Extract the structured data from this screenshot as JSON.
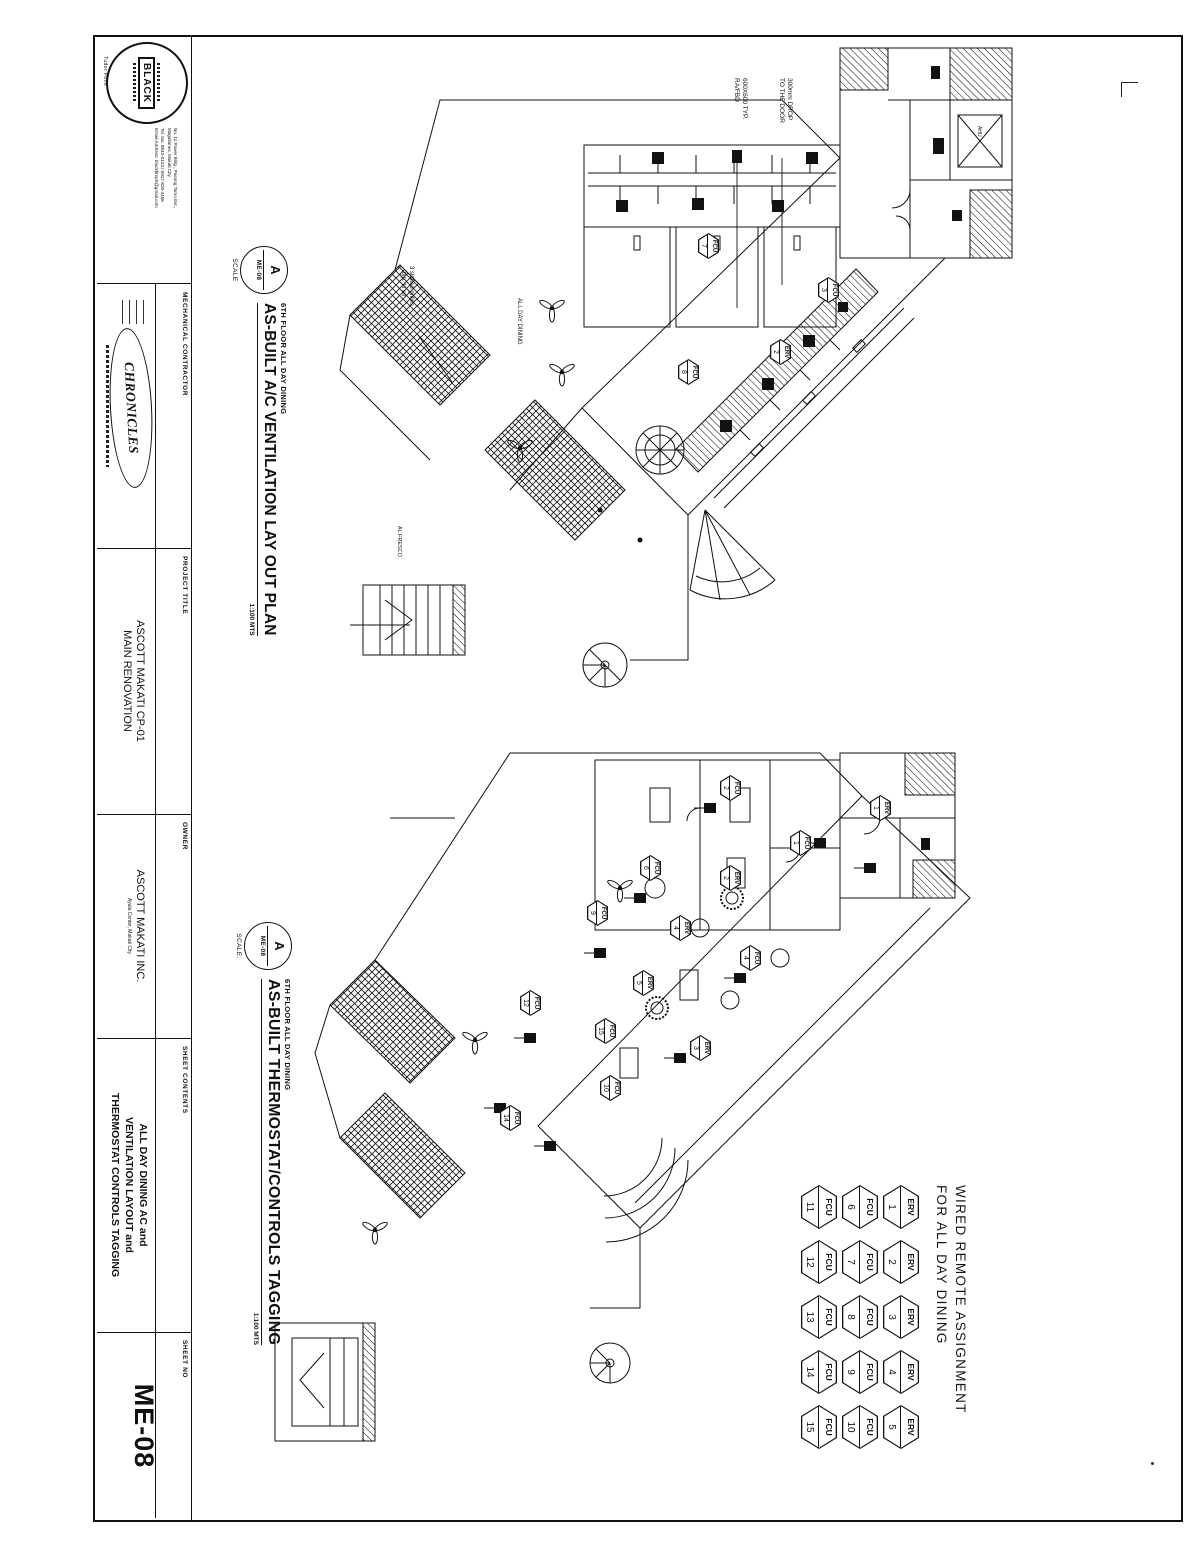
{
  "page": {
    "bg": "#ffffff",
    "ink": "#111111"
  },
  "titleblock": {
    "logo": {
      "text": "BLACK",
      "tagline": "Tudor Point",
      "address_lines": [
        "No. 11 Power Bldg., Pasong Tamo Ext.,",
        "Magallanes, Makati City",
        "Tel. No. 8844-0123 / 0917-820-4455",
        "Email Address: blackfireph@gmail.com"
      ]
    },
    "contractor": {
      "label": "MECHANICAL CONTRACTOR",
      "stamp": "CHRONICLES"
    },
    "project": {
      "label": "PROJECT TITLE",
      "line1": "ASCOTT MAKATI CP-01",
      "line2": "MAIN RENOVATION"
    },
    "owner": {
      "label": "OWNER",
      "name": "ASCOTT MAKATI INC.",
      "address": "Ayala Center, Makati City"
    },
    "contents": {
      "label": "SHEET CONTENTS",
      "line1": "ALL DAY DINING AC and",
      "line2": "VENTILATION LAYOUT and",
      "line3": "THERMOSTAT CONTROLS TAGGING"
    },
    "sheet_no": {
      "label": "SHEET NO",
      "value": "ME-08"
    }
  },
  "plan1": {
    "context": "6TH FLOOR ALL DAY DINING",
    "title": "AS-BUILT A/C VENTILATION LAY OUT PLAN",
    "bubble_top": "A",
    "bubble_bottom": "ME-08",
    "scale_label": "SCALE",
    "scale_value": "1:100 MTS",
    "callouts": {
      "c1a": "300mm DROP",
      "c1b": "TO THE DOOR",
      "c2a": "600X600 TYP.",
      "c2b": "RA/FBD",
      "c3a": "3 slotted grilles",
      "c3b": "typ. to all"
    },
    "labels": {
      "ahu": "AHU",
      "dining": "ALL DAY DINING",
      "alfresco": "AL FRESCO"
    },
    "tags": [
      {
        "t": "FCU",
        "n": "3",
        "x": 290,
        "y": 372
      },
      {
        "t": "ERV",
        "n": "2",
        "x": 352,
        "y": 420
      },
      {
        "t": "FCU",
        "n": "7",
        "x": 246,
        "y": 492
      },
      {
        "t": "FCU",
        "n": "8",
        "x": 372,
        "y": 512
      }
    ]
  },
  "plan2": {
    "context": "6TH FLOOR ALL DAY DINING",
    "title": "AS-BUILT THERMOSTAT/CONTROLS TAGGING",
    "bubble_top": "A",
    "bubble_bottom": "ME-08",
    "scale_label": "SCALE:",
    "scale_value": "1:100 MTS",
    "tags": [
      {
        "t": "ERV",
        "n": "1",
        "x": 808,
        "y": 320
      },
      {
        "t": "FCU",
        "n": "1",
        "x": 843,
        "y": 400
      },
      {
        "t": "FCU",
        "n": "2",
        "x": 788,
        "y": 470
      },
      {
        "t": "ERV",
        "n": "2",
        "x": 878,
        "y": 470
      },
      {
        "t": "FCU",
        "n": "4",
        "x": 958,
        "y": 450
      },
      {
        "t": "ERV",
        "n": "4",
        "x": 928,
        "y": 520
      },
      {
        "t": "FCU",
        "n": "6",
        "x": 868,
        "y": 550
      },
      {
        "t": "ERV",
        "n": "3",
        "x": 1048,
        "y": 500
      },
      {
        "t": "FCU",
        "n": "9",
        "x": 913,
        "y": 603
      },
      {
        "t": "ERV",
        "n": "5",
        "x": 983,
        "y": 557
      },
      {
        "t": "FCU",
        "n": "10",
        "x": 1088,
        "y": 590
      },
      {
        "t": "FCU",
        "n": "15",
        "x": 1031,
        "y": 595
      },
      {
        "t": "FCU",
        "n": "12",
        "x": 1003,
        "y": 670
      },
      {
        "t": "FCU",
        "n": "14",
        "x": 1118,
        "y": 690
      }
    ]
  },
  "remote": {
    "heading1": "WIRED REMOTE ASSIGNMENT",
    "heading2": "FOR ALL DAY DINING",
    "rows": [
      {
        "label": "ERV",
        "nums": [
          "1",
          "2",
          "3",
          "4",
          "5"
        ]
      },
      {
        "label": "FCU",
        "nums": [
          "6",
          "7",
          "8",
          "9",
          "10"
        ]
      },
      {
        "label": "FCU",
        "nums": [
          "11",
          "12",
          "13",
          "14",
          "15"
        ]
      }
    ]
  }
}
